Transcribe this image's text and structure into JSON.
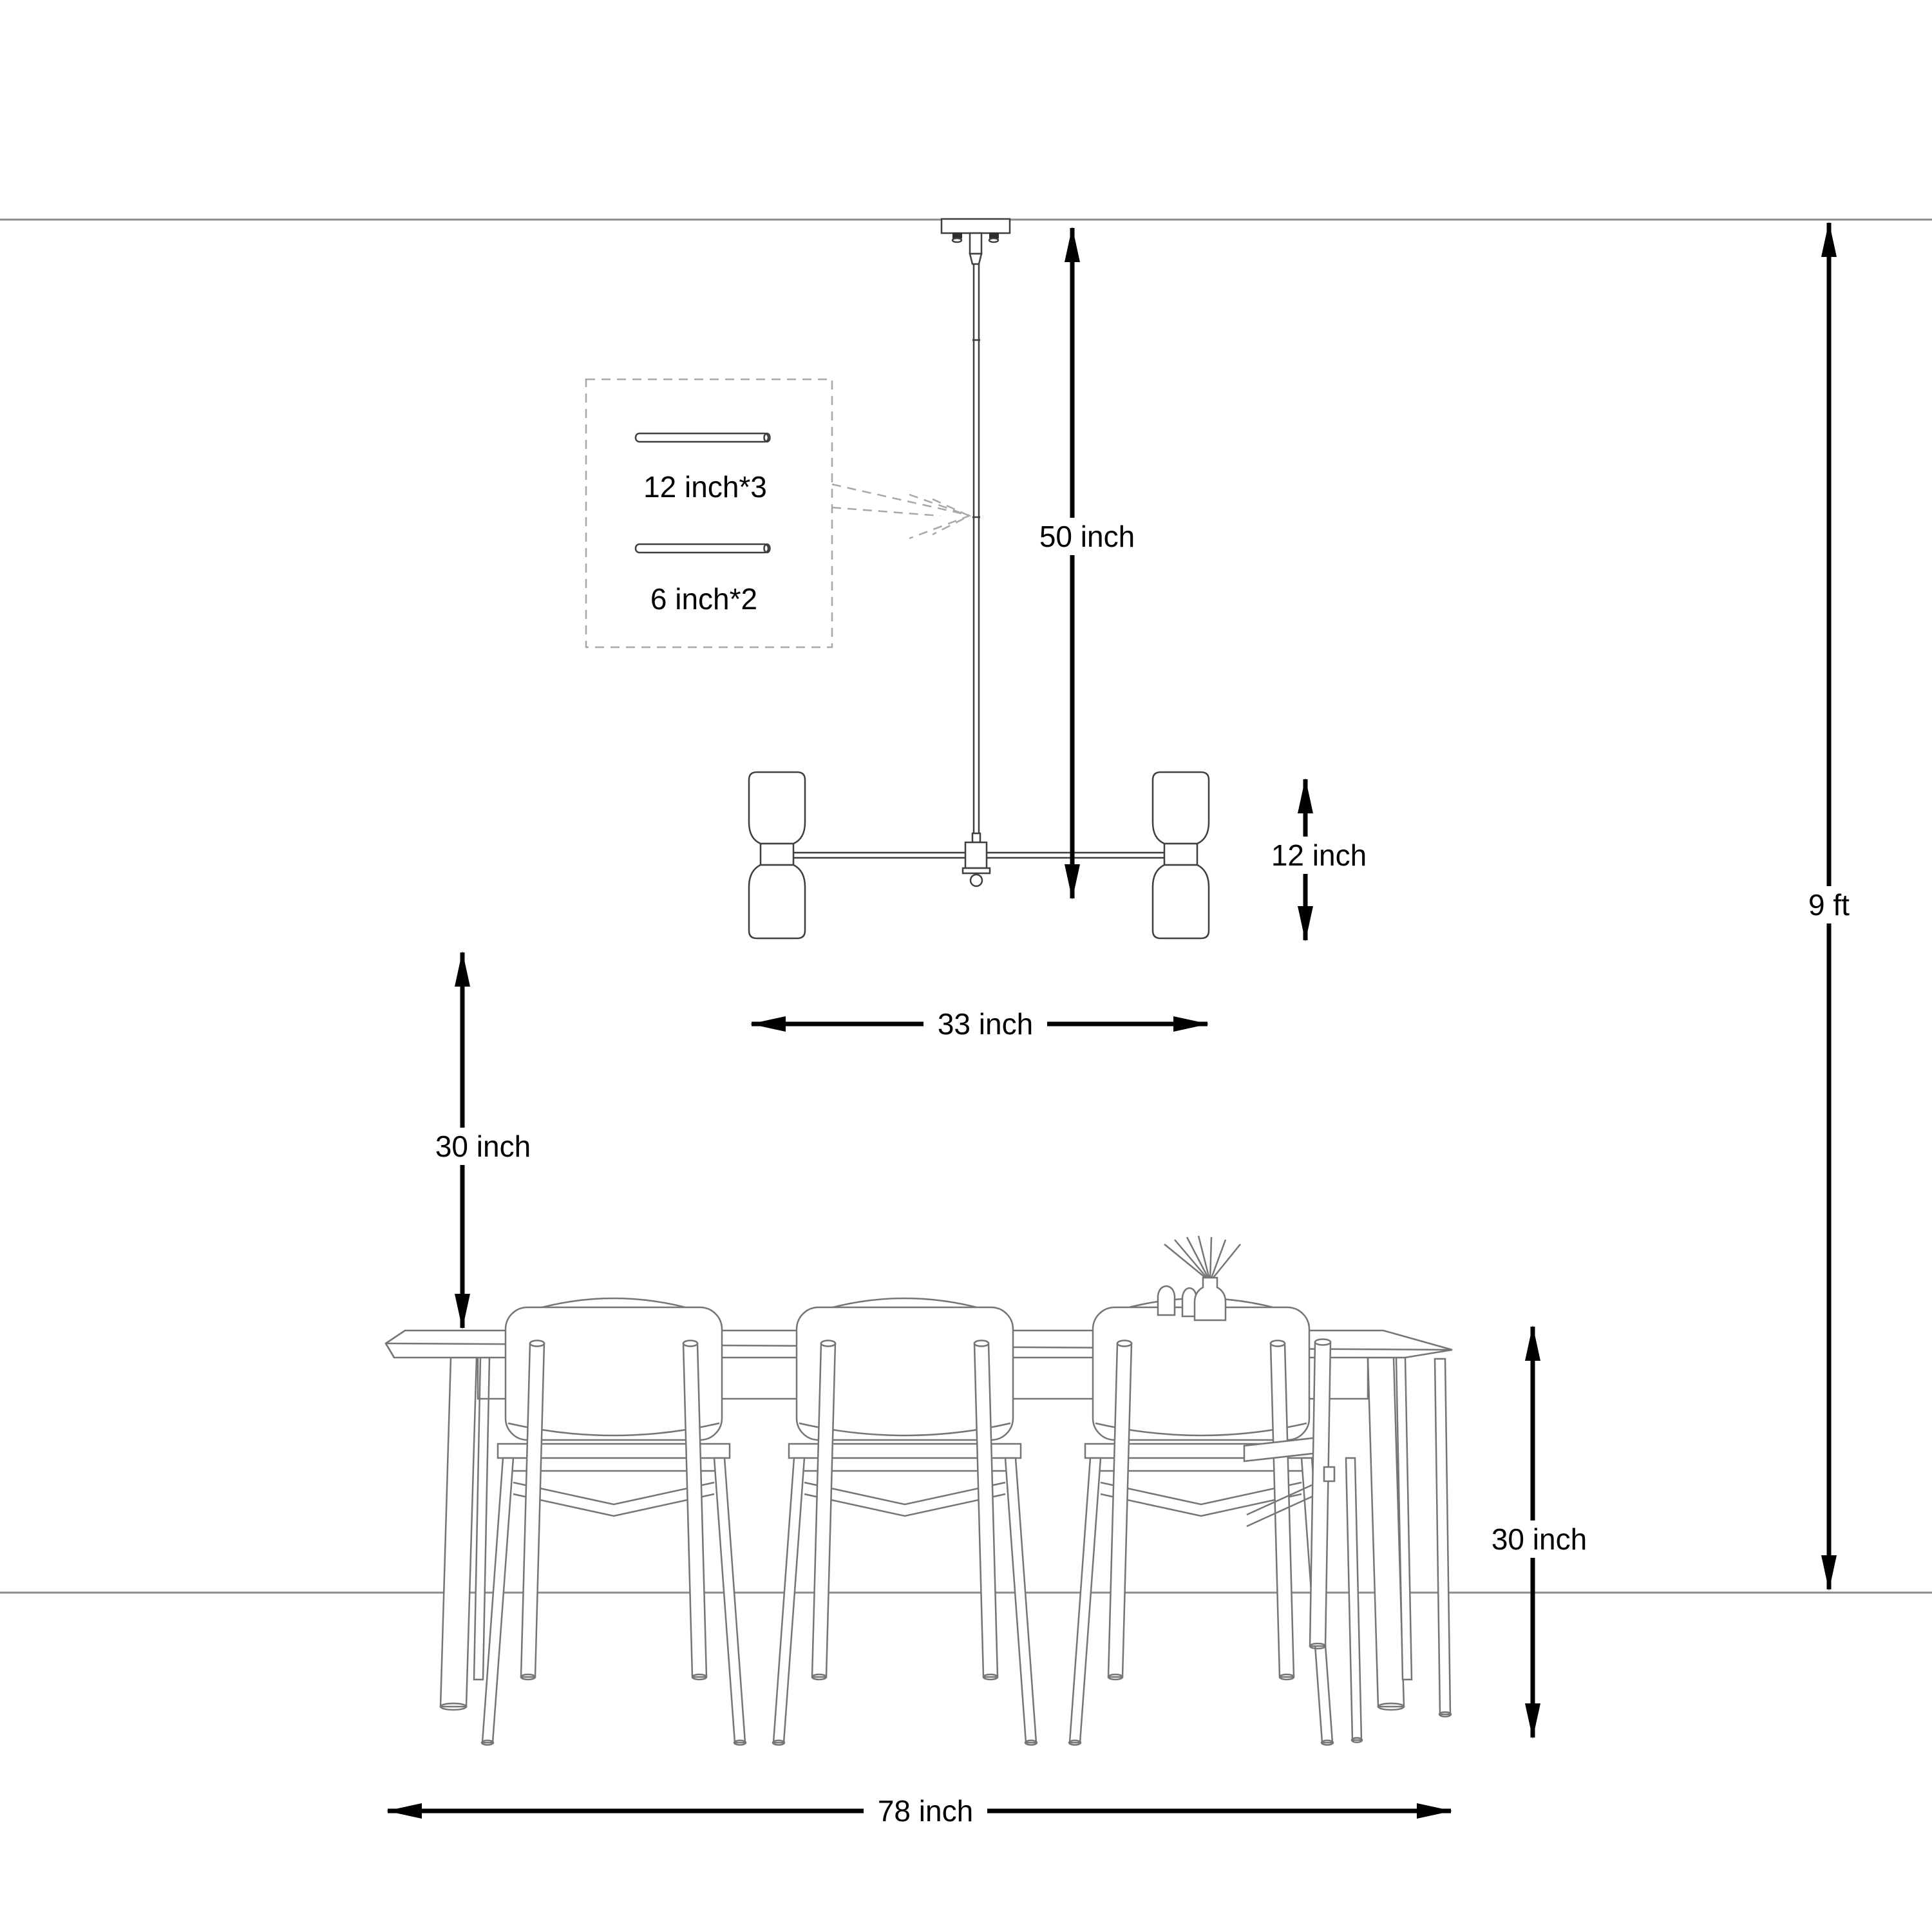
{
  "diagram": {
    "rod_box": {
      "long_rod": "12 inch*3",
      "short_rod": "6 inch*2"
    },
    "dimensions": {
      "drop_height": "50 inch",
      "lamp_height": "12 inch",
      "fixture_width": "33 inch",
      "fixture_to_table": "30 inch",
      "ceiling_height": "9 ft",
      "table_height": "30 inch",
      "table_length": "78 inch"
    },
    "colors": {
      "background": "#ffffff",
      "room_line": "#8c8c8c",
      "fixture_line": "#3f3f3f",
      "furniture_line": "#757575",
      "dashed_line": "#a8a8a8",
      "dimension": "#000000"
    }
  }
}
